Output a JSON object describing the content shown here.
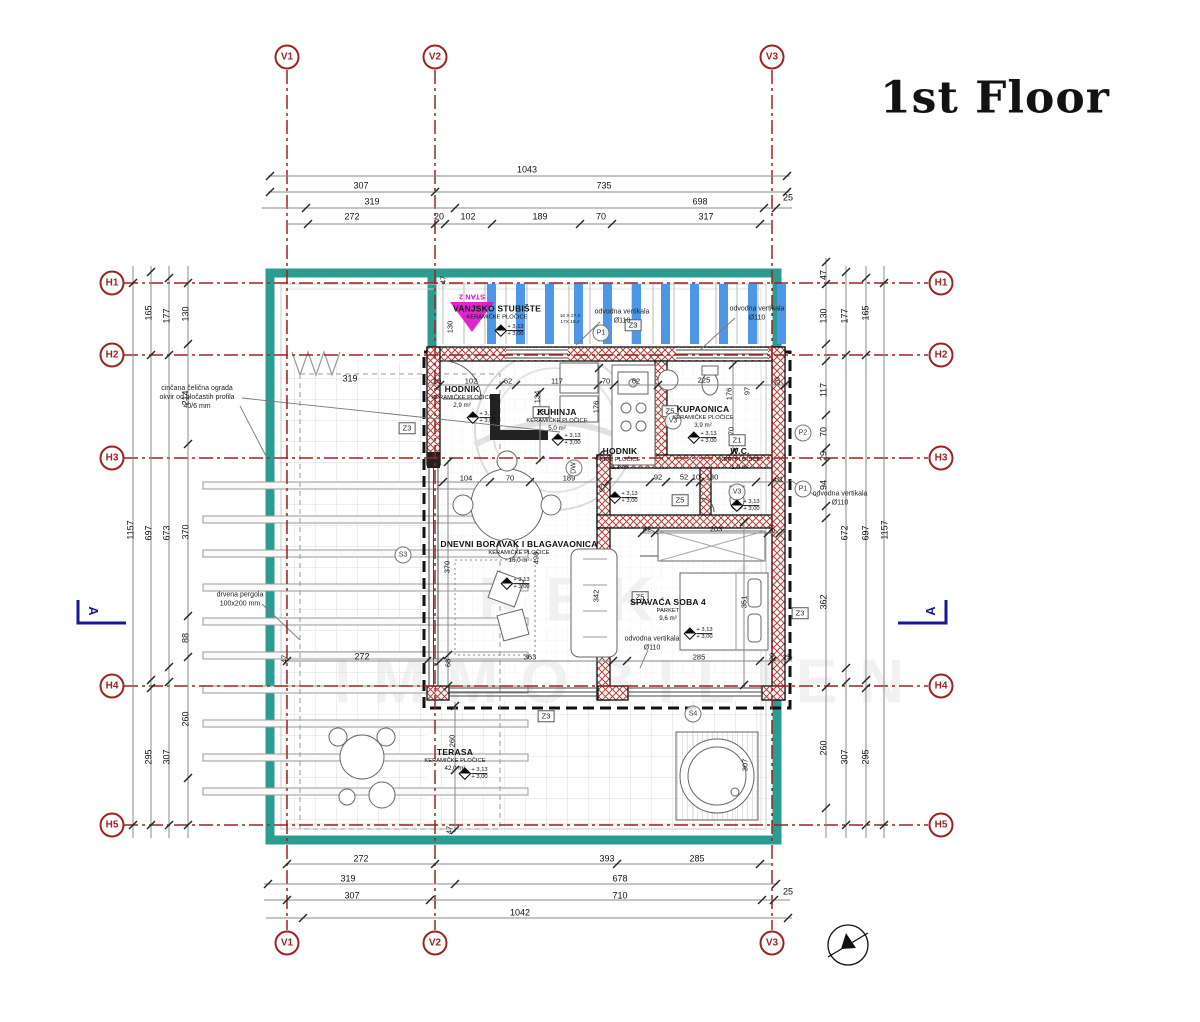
{
  "title": "1st Floor",
  "watermark": {
    "line1": "REKIĆ",
    "line2": "IMMOBILIEN"
  },
  "colors": {
    "grid_red": "#9b2420",
    "teal": "#2b9c91",
    "bar_blue": "#4e97e8",
    "magenta": "#d911c9",
    "section_navy": "#1a1796",
    "wall_hatch_red": "#b0413a",
    "dim_line": "#8a8a8a"
  },
  "grid_markers": [
    {
      "id": "V1",
      "x": 287,
      "y": 57
    },
    {
      "id": "V2",
      "x": 435,
      "y": 57
    },
    {
      "id": "V3",
      "x": 772,
      "y": 57
    },
    {
      "id": "V1",
      "x": 287,
      "y": 943
    },
    {
      "id": "V2",
      "x": 435,
      "y": 943
    },
    {
      "id": "V3",
      "x": 772,
      "y": 943
    },
    {
      "id": "H1",
      "x": 112,
      "y": 283
    },
    {
      "id": "H2",
      "x": 112,
      "y": 355
    },
    {
      "id": "H3",
      "x": 112,
      "y": 458
    },
    {
      "id": "H4",
      "x": 112,
      "y": 686
    },
    {
      "id": "H5",
      "x": 112,
      "y": 825
    },
    {
      "id": "H1",
      "x": 941,
      "y": 283
    },
    {
      "id": "H2",
      "x": 941,
      "y": 355
    },
    {
      "id": "H3",
      "x": 941,
      "y": 458
    },
    {
      "id": "H4",
      "x": 941,
      "y": 686
    },
    {
      "id": "H5",
      "x": 941,
      "y": 825
    }
  ],
  "rooms": [
    {
      "name": "VANJSKO STUBIŠTE",
      "mat": "KERAMIČKE PLOČICE",
      "area": "",
      "x": 497,
      "y": 313
    },
    {
      "name": "HODNIK",
      "mat": "KERAMIČKE PLOČICE",
      "area": "2,9 m²",
      "x": 462,
      "y": 397
    },
    {
      "name": "KUHINJA",
      "mat": "KERAMIČKE PLOČICE",
      "area": "5,0 m²",
      "x": 557,
      "y": 420
    },
    {
      "name": "KUPAONICA",
      "mat": "KERAMIČKE PLOČICE",
      "area": "3,9 m²",
      "x": 703,
      "y": 417
    },
    {
      "name": "HODNIK",
      "mat": "KER. PLOČICE",
      "area": "1,3 m²",
      "x": 620,
      "y": 459
    },
    {
      "name": "W.C.",
      "mat": "KER. PLOČICE",
      "area": "1,0 m²",
      "x": 740,
      "y": 459
    },
    {
      "name": "DNEVNI BORAVAK I BLAGAVAONICA",
      "mat": "KERAMIČKE PLOČICE",
      "area": "16,0 m²",
      "x": 519,
      "y": 552
    },
    {
      "name": "SPAVAĆA SOBA 4",
      "mat": "PARKET",
      "area": "9,6 m²",
      "x": 668,
      "y": 610
    },
    {
      "name": "TERASA",
      "mat": "KERAMIČKE PLOČICE",
      "area": "42,0 m²",
      "x": 455,
      "y": 760
    }
  ],
  "levels": [
    {
      "x": 482,
      "y": 418
    },
    {
      "x": 567,
      "y": 440
    },
    {
      "x": 510,
      "y": 331
    },
    {
      "x": 703,
      "y": 438
    },
    {
      "x": 746,
      "y": 506
    },
    {
      "x": 624,
      "y": 498
    },
    {
      "x": 516,
      "y": 584
    },
    {
      "x": 699,
      "y": 634
    },
    {
      "x": 474,
      "y": 774
    }
  ],
  "level_text": {
    "top": "+ 3,13",
    "bottom": "+ 3,00"
  },
  "section_letters": [
    {
      "t": "A",
      "x": 93,
      "y": 611,
      "rot": 90
    },
    {
      "t": "A",
      "x": 931,
      "y": 611,
      "rot": -90
    }
  ],
  "notes": [
    {
      "lines": [
        "cinčana čelična ograda",
        "okvir od pločastih profila",
        "40/6 mm"
      ],
      "x": 197,
      "y": 398
    },
    {
      "lines": [
        "drvena pergola",
        "100x200 mm"
      ],
      "x": 240,
      "y": 600
    },
    {
      "lines": [
        "odvodna vertikala",
        "Ø110"
      ],
      "x": 622,
      "y": 317
    },
    {
      "lines": [
        "odvodna vertikala",
        "Ø110"
      ],
      "x": 757,
      "y": 314
    },
    {
      "lines": [
        "odvodna vertikala",
        "Ø110"
      ],
      "x": 840,
      "y": 499
    },
    {
      "lines": [
        "odvodna vertikala",
        "Ø110"
      ],
      "x": 652,
      "y": 644
    },
    {
      "lines": [
        "16 X 27,0",
        "17X 18,2"
      ],
      "x": 570,
      "y": 320,
      "size": 4.8
    },
    {
      "lines": [
        "STAN 2"
      ],
      "x": 472,
      "y": 297,
      "rot": 180,
      "color": "#d911c9",
      "bold": true,
      "size": 7.5
    }
  ],
  "zone_boxes": [
    {
      "t": "Z3",
      "x": 407,
      "y": 428
    },
    {
      "t": "Z3",
      "x": 633,
      "y": 325
    },
    {
      "t": "Z3",
      "x": 800,
      "y": 613
    },
    {
      "t": "Z3",
      "x": 546,
      "y": 716
    },
    {
      "t": "Z5",
      "x": 541,
      "y": 412
    },
    {
      "t": "Z5",
      "x": 670,
      "y": 411
    },
    {
      "t": "Z5",
      "x": 640,
      "y": 597
    },
    {
      "t": "Z5",
      "x": 680,
      "y": 500
    },
    {
      "t": "Z1",
      "x": 737,
      "y": 440
    }
  ],
  "circle_labels": [
    {
      "t": "P1",
      "x": 601,
      "y": 333
    },
    {
      "t": "P1",
      "x": 803,
      "y": 489
    },
    {
      "t": "P2",
      "x": 803,
      "y": 433
    },
    {
      "t": "S3",
      "x": 403,
      "y": 555
    },
    {
      "t": "S4",
      "x": 693,
      "y": 714
    },
    {
      "t": "V3",
      "x": 673,
      "y": 421
    },
    {
      "t": "V3",
      "x": 737,
      "y": 492
    },
    {
      "t": "DW",
      "x": 574,
      "y": 468,
      "rot": -90
    }
  ],
  "dims": [
    {
      "t": "1043",
      "x": 527,
      "y": 170
    },
    {
      "t": "307",
      "x": 361,
      "y": 186
    },
    {
      "t": "735",
      "x": 604,
      "y": 186
    },
    {
      "t": "319",
      "x": 372,
      "y": 202
    },
    {
      "t": "698",
      "x": 700,
      "y": 202
    },
    {
      "t": "25",
      "x": 788,
      "y": 198
    },
    {
      "t": "272",
      "x": 352,
      "y": 217
    },
    {
      "t": "20",
      "x": 439,
      "y": 217
    },
    {
      "t": "102",
      "x": 468,
      "y": 217
    },
    {
      "t": "189",
      "x": 540,
      "y": 217
    },
    {
      "t": "70",
      "x": 601,
      "y": 217
    },
    {
      "t": "317",
      "x": 706,
      "y": 217
    },
    {
      "t": "272",
      "x": 361,
      "y": 859
    },
    {
      "t": "393",
      "x": 607,
      "y": 859
    },
    {
      "t": "285",
      "x": 697,
      "y": 859
    },
    {
      "t": "319",
      "x": 348,
      "y": 879
    },
    {
      "t": "678",
      "x": 620,
      "y": 879
    },
    {
      "t": "307",
      "x": 352,
      "y": 896
    },
    {
      "t": "710",
      "x": 620,
      "y": 896
    },
    {
      "t": "25",
      "x": 788,
      "y": 892
    },
    {
      "t": "1042",
      "x": 520,
      "y": 913
    },
    {
      "t": "1157",
      "x": 131,
      "y": 530,
      "rot": -90
    },
    {
      "t": "165",
      "x": 149,
      "y": 313,
      "rot": -90
    },
    {
      "t": "697",
      "x": 149,
      "y": 533,
      "rot": -90
    },
    {
      "t": "295",
      "x": 149,
      "y": 757,
      "rot": -90
    },
    {
      "t": "177",
      "x": 167,
      "y": 316,
      "rot": -90
    },
    {
      "t": "673",
      "x": 167,
      "y": 533,
      "rot": -90
    },
    {
      "t": "307",
      "x": 167,
      "y": 757,
      "rot": -90
    },
    {
      "t": "130",
      "x": 186,
      "y": 314,
      "rot": -90
    },
    {
      "t": "214",
      "x": 186,
      "y": 398,
      "rot": -90
    },
    {
      "t": "370",
      "x": 186,
      "y": 532,
      "rot": -90
    },
    {
      "t": "88",
      "x": 186,
      "y": 638,
      "rot": -90
    },
    {
      "t": "260",
      "x": 186,
      "y": 719,
      "rot": -90
    },
    {
      "t": "47",
      "x": 824,
      "y": 275,
      "rot": -90
    },
    {
      "t": "130",
      "x": 824,
      "y": 316,
      "rot": -90
    },
    {
      "t": "117",
      "x": 824,
      "y": 390,
      "rot": -90
    },
    {
      "t": "70",
      "x": 824,
      "y": 432,
      "rot": -90
    },
    {
      "t": "29",
      "x": 824,
      "y": 456,
      "rot": -90
    },
    {
      "t": "94",
      "x": 824,
      "y": 485,
      "rot": -90
    },
    {
      "t": "362",
      "x": 824,
      "y": 602,
      "rot": -90
    },
    {
      "t": "260",
      "x": 824,
      "y": 748,
      "rot": -90
    },
    {
      "t": "177",
      "x": 845,
      "y": 316,
      "rot": -90
    },
    {
      "t": "672",
      "x": 845,
      "y": 533,
      "rot": -90
    },
    {
      "t": "307",
      "x": 845,
      "y": 757,
      "rot": -90
    },
    {
      "t": "165",
      "x": 866,
      "y": 313,
      "rot": -90
    },
    {
      "t": "697",
      "x": 866,
      "y": 533,
      "rot": -90
    },
    {
      "t": "295",
      "x": 866,
      "y": 757,
      "rot": -90
    },
    {
      "t": "1157",
      "x": 885,
      "y": 530,
      "rot": -90
    },
    {
      "t": "130",
      "x": 450,
      "y": 327,
      "rot": -90,
      "small": true
    },
    {
      "t": "47",
      "x": 443,
      "y": 280,
      "rot": -90,
      "small": true
    },
    {
      "t": "20",
      "x": 437,
      "y": 381,
      "small": true
    },
    {
      "t": "102",
      "x": 471,
      "y": 381,
      "small": true
    },
    {
      "t": "62",
      "x": 508,
      "y": 381,
      "small": true
    },
    {
      "t": "117",
      "x": 557,
      "y": 381,
      "small": true
    },
    {
      "t": "70",
      "x": 606,
      "y": 381,
      "small": true
    },
    {
      "t": "62",
      "x": 636,
      "y": 381,
      "small": true
    },
    {
      "t": "225",
      "x": 704,
      "y": 380,
      "small": true
    },
    {
      "t": "20",
      "x": 777,
      "y": 381,
      "rot": -90,
      "small": true
    },
    {
      "t": "134",
      "x": 537,
      "y": 397,
      "rot": -90,
      "small": true
    },
    {
      "t": "176",
      "x": 596,
      "y": 407,
      "rot": -90,
      "small": true
    },
    {
      "t": "176",
      "x": 729,
      "y": 394,
      "rot": -90,
      "small": true
    },
    {
      "t": "97",
      "x": 747,
      "y": 391,
      "rot": -90,
      "small": true
    },
    {
      "t": "70",
      "x": 731,
      "y": 431,
      "rot": -90,
      "small": true
    },
    {
      "t": "319",
      "x": 350,
      "y": 379
    },
    {
      "t": "104",
      "x": 466,
      "y": 478,
      "small": true
    },
    {
      "t": "70",
      "x": 510,
      "y": 478,
      "small": true
    },
    {
      "t": "189",
      "x": 569,
      "y": 478,
      "small": true
    },
    {
      "t": "95",
      "x": 602,
      "y": 488,
      "rot": -90,
      "small": true
    },
    {
      "t": "92",
      "x": 658,
      "y": 477,
      "small": true
    },
    {
      "t": "52",
      "x": 684,
      "y": 477,
      "small": true
    },
    {
      "t": "10",
      "x": 696,
      "y": 477,
      "small": true
    },
    {
      "t": "130",
      "x": 712,
      "y": 477,
      "small": true
    },
    {
      "t": "31",
      "x": 779,
      "y": 479,
      "small": true
    },
    {
      "t": "82",
      "x": 647,
      "y": 529,
      "small": true
    },
    {
      "t": "203",
      "x": 716,
      "y": 529,
      "small": true
    },
    {
      "t": "20",
      "x": 772,
      "y": 529,
      "rot": -90,
      "small": true
    },
    {
      "t": "370",
      "x": 447,
      "y": 567,
      "rot": -90,
      "small": true
    },
    {
      "t": "498",
      "x": 536,
      "y": 558,
      "rot": -90,
      "small": true
    },
    {
      "t": "342",
      "x": 596,
      "y": 596,
      "rot": -90,
      "small": true
    },
    {
      "t": "351",
      "x": 744,
      "y": 602,
      "rot": -90,
      "small": true
    },
    {
      "t": "272",
      "x": 362,
      "y": 657
    },
    {
      "t": "47",
      "x": 284,
      "y": 659,
      "rot": -90,
      "small": true
    },
    {
      "t": "68",
      "x": 448,
      "y": 663,
      "rot": -90,
      "small": true
    },
    {
      "t": "363",
      "x": 530,
      "y": 657,
      "small": true
    },
    {
      "t": "285",
      "x": 699,
      "y": 657,
      "small": true
    },
    {
      "t": "20",
      "x": 772,
      "y": 657,
      "rot": -90,
      "small": true
    },
    {
      "t": "25",
      "x": 787,
      "y": 657,
      "small": true
    },
    {
      "t": "260",
      "x": 452,
      "y": 741,
      "rot": -90,
      "small": true
    },
    {
      "t": "307",
      "x": 745,
      "y": 765,
      "rot": -90,
      "small": true
    },
    {
      "t": "47",
      "x": 449,
      "y": 830,
      "rot": -90,
      "small": true
    }
  ],
  "dim_lines": {
    "h": [
      {
        "y": 176,
        "x1": 268,
        "x2": 790,
        "ticks": [
          270,
          787
        ]
      },
      {
        "y": 192,
        "x1": 268,
        "x2": 790,
        "ticks": [
          270,
          435,
          787
        ]
      },
      {
        "y": 208,
        "x1": 262,
        "x2": 792,
        "ticks": [
          306,
          455,
          764,
          776
        ]
      },
      {
        "y": 224,
        "x1": 287,
        "x2": 772,
        "ticks": [
          308,
          435,
          445,
          492,
          580,
          612,
          760
        ]
      },
      {
        "y": 864,
        "x1": 287,
        "x2": 772,
        "ticks": [
          287,
          435,
          617,
          760
        ]
      },
      {
        "y": 884,
        "x1": 264,
        "x2": 778,
        "ticks": [
          268,
          455,
          776
        ]
      },
      {
        "y": 900,
        "x1": 264,
        "x2": 790,
        "ticks": [
          287,
          430,
          762,
          774
        ]
      },
      {
        "y": 918,
        "x1": 266,
        "x2": 792,
        "ticks": [
          303,
          788
        ]
      },
      {
        "y": 385,
        "x1": 427,
        "x2": 788,
        "ticks": [
          440,
          500,
          516,
          598,
          614,
          658,
          760,
          785
        ]
      },
      {
        "y": 482,
        "x1": 440,
        "x2": 788,
        "ticks": [
          443,
          490,
          530,
          608,
          650,
          666,
          690,
          700,
          756,
          772
        ]
      },
      {
        "y": 533,
        "x1": 640,
        "x2": 786,
        "ticks": [
          642,
          655,
          768,
          780
        ]
      },
      {
        "y": 661,
        "x1": 285,
        "x2": 792,
        "ticks": [
          287,
          427,
          440,
          613,
          627,
          760,
          772,
          788
        ]
      }
    ],
    "v": [
      {
        "x": 133,
        "y1": 266,
        "y2": 838,
        "ticks": [
          283,
          825
        ]
      },
      {
        "x": 151,
        "y1": 266,
        "y2": 838,
        "ticks": [
          272,
          355,
          680,
          688,
          825
        ]
      },
      {
        "x": 169,
        "y1": 266,
        "y2": 838,
        "ticks": [
          278,
          355,
          667,
          682,
          825
        ]
      },
      {
        "x": 188,
        "y1": 266,
        "y2": 838,
        "ticks": [
          283,
          344,
          444,
          616,
          657,
          778,
          825
        ]
      },
      {
        "x": 826,
        "y1": 258,
        "y2": 838,
        "ticks": [
          262,
          284,
          344,
          361,
          415,
          448,
          462,
          506,
          518,
          687,
          808
        ]
      },
      {
        "x": 846,
        "y1": 266,
        "y2": 838,
        "ticks": [
          272,
          355,
          668,
          682,
          825
        ]
      },
      {
        "x": 866,
        "y1": 266,
        "y2": 838,
        "ticks": [
          278,
          355,
          680,
          688,
          825
        ]
      },
      {
        "x": 884,
        "y1": 266,
        "y2": 838,
        "ticks": [
          283,
          825
        ]
      },
      {
        "x": 448,
        "y1": 460,
        "y2": 688,
        "ticks": [
          462,
          655,
          686
        ]
      },
      {
        "x": 540,
        "y1": 390,
        "y2": 462,
        "ticks": [
          392,
          460
        ]
      },
      {
        "x": 599,
        "y1": 365,
        "y2": 460,
        "ticks": [
          368,
          455
        ]
      },
      {
        "x": 744,
        "y1": 520,
        "y2": 688,
        "ticks": [
          522,
          685
        ]
      },
      {
        "x": 455,
        "y1": 702,
        "y2": 832,
        "ticks": [
          706,
          770,
          830
        ]
      },
      {
        "x": 733,
        "y1": 362,
        "y2": 455,
        "ticks": [
          365,
          452
        ]
      }
    ]
  },
  "decor": {
    "stair_bars": {
      "x0": 487,
      "dx": 29,
      "count": 11,
      "y": 284,
      "w": 9,
      "h": 60
    },
    "treads": {
      "x0": 443,
      "dx": 21,
      "count": 16,
      "y1": 282,
      "y2": 344
    },
    "pergola_strips": {
      "x": 203,
      "w": 325,
      "h": 7,
      "ys": [
        482,
        516,
        550,
        584,
        618,
        652,
        686,
        720,
        754,
        788
      ]
    }
  }
}
